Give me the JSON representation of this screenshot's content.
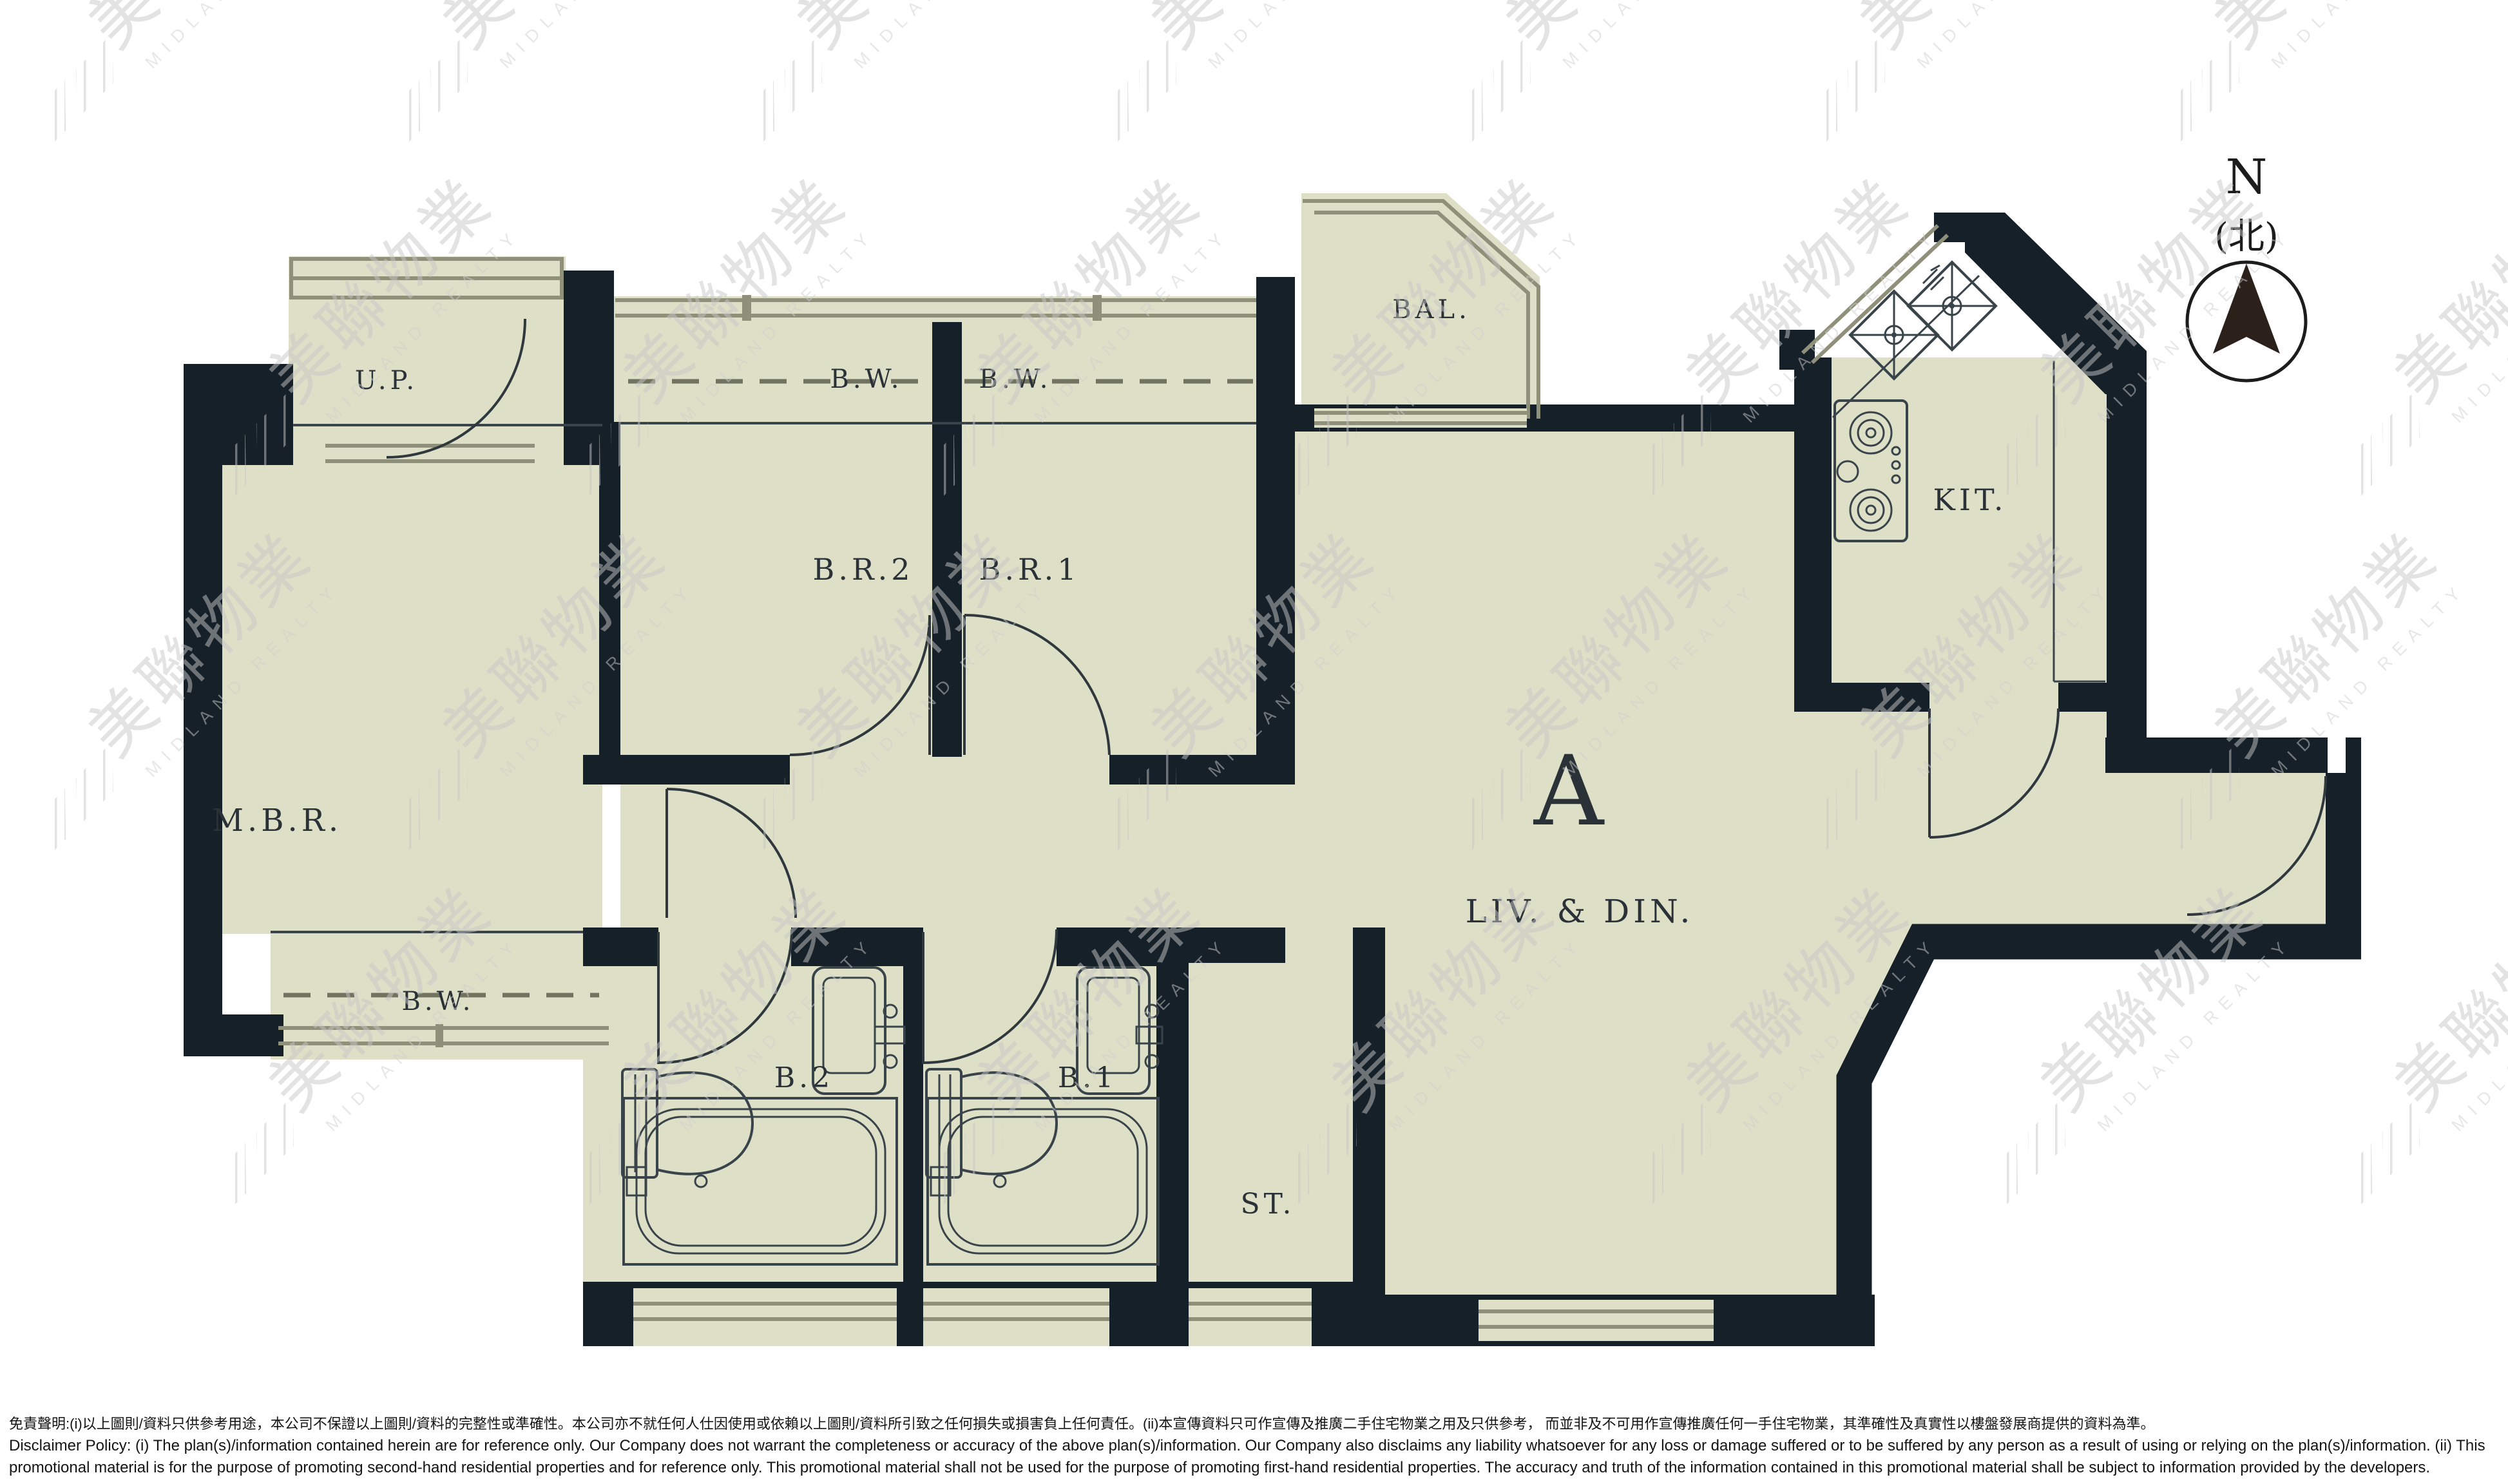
{
  "compass": {
    "n": "N",
    "north_cn": "(北)"
  },
  "watermark": {
    "cn": "美聯物業",
    "en": "MIDLAND REALTY"
  },
  "unit_label": "A",
  "labels": {
    "up": "U.P.",
    "bw": "B.W.",
    "br2": "B.R.2",
    "br1": "B.R.1",
    "bal": "BAL.",
    "kit": "KIT.",
    "mbr": "M.B.R.",
    "livdin": "LIV. & DIN.",
    "b2": "B.2",
    "b1": "B.1",
    "st": "ST."
  },
  "disclaimer": {
    "zh": "免責聲明:(i)以上圖則/資料只供參考用途，本公司不保證以上圖則/資料的完整性或準確性。本公司亦不就任何人仕因使用或依賴以上圖則/資料所引致之任何損失或損害負上任何責任。(ii)本宣傳資料只可作宣傳及推廣二手住宅物業之用及只供參考， 而並非及不可用作宣傳推廣任何一手住宅物業，其準確性及真實性以樓盤發展商提供的資料為準。",
    "en": "Disclaimer Policy: (i) The plan(s)/information contained herein are for reference only. Our Company does not warrant the completeness or accuracy of the above plan(s)/information. Our Company also disclaims any liability whatsoever for any loss or damage suffered or to be suffered by any person as a result of using or relying on the plan(s)/information. (ii) This promotional material is for the purpose of promoting second-hand residential properties and for reference only. This promotional material shall not be used for the purpose of promoting first-hand residential properties. The accuracy and truth of the information contained in this promotional material shall be subject to information provided by the developers."
  },
  "colors": {
    "wall": "#152028",
    "floor": "#dde0c6",
    "line": "#39434a",
    "window": "#8e9079",
    "label": "#2a3137",
    "watermark": "#c7c7c7"
  }
}
